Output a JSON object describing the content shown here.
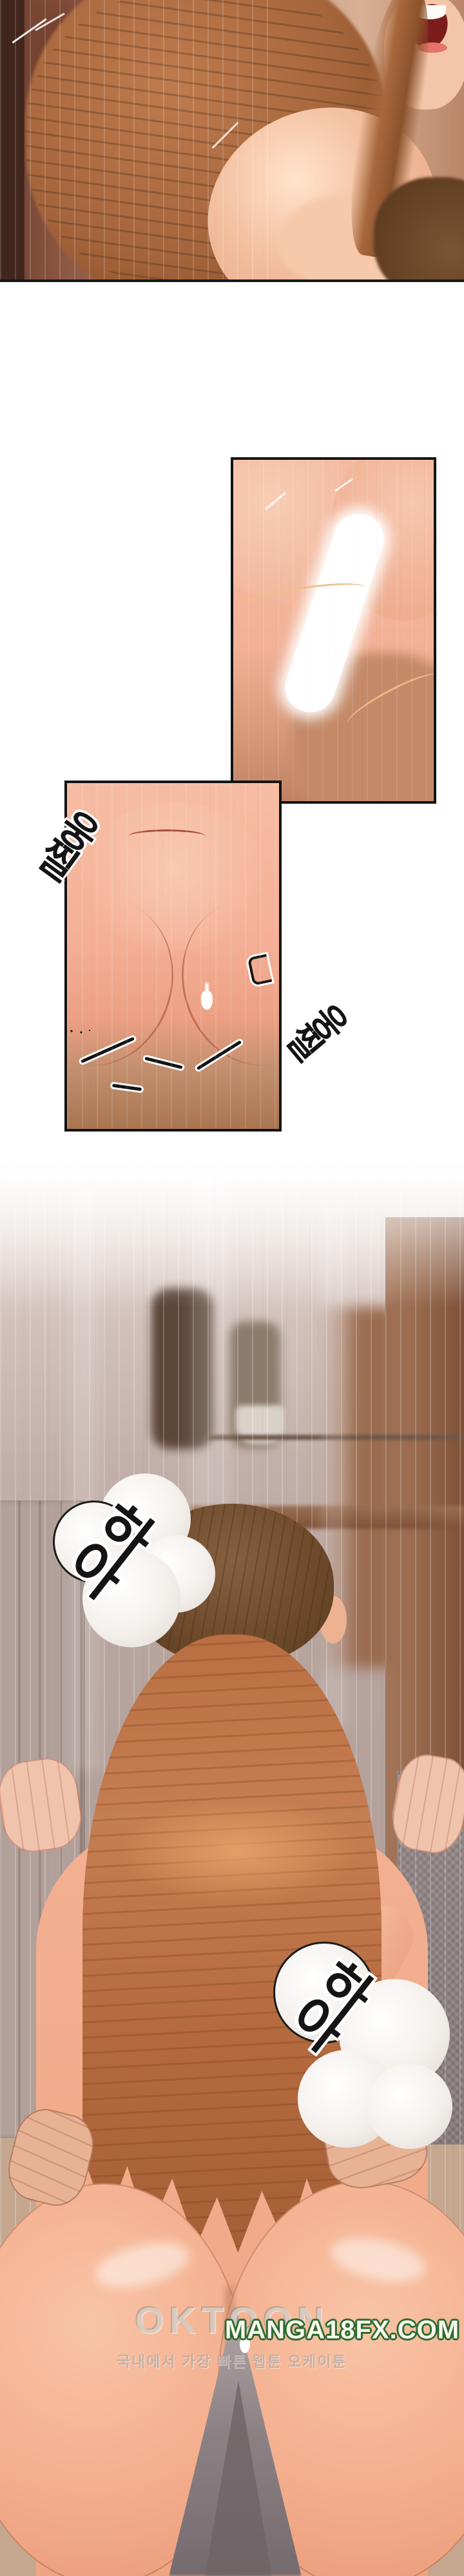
{
  "page": {
    "type": "webtoon-episode-strip",
    "language": "Korean",
    "background": "#ffffff"
  },
  "sfx": {
    "moan_1": "하아",
    "moan_2": "하아",
    "twitch_1": "웅찔",
    "twitch_2": "웅찔"
  },
  "watermark": {
    "site_name": "OKTOON",
    "site_url": "MANGA18FX.COM",
    "tagline_korean": "국내에서 가장 빠른 웹툰 오케이툰"
  },
  "panels": {
    "panel_1": "full-bleed close-up of two figures, auburn-haired woman in profile, warm wall background",
    "panel_2": "bordered close-up with bright white highlight shape over skin tones",
    "panel_3": "bordered lower-body close-up with sound-effect squiggles",
    "panel_4": "tall shower-room scene, man's brown head and woman's long auburn hair from behind, blurred shelf with bottles, wood and tile walls"
  },
  "palette": {
    "skin_light": "#f5c3ab",
    "skin_mid": "#f0ad8d",
    "skin_tan": "#c08264",
    "hair_woman": "#b06a42",
    "hair_man": "#6f4a2b",
    "wood_wall": "#9b6b4e",
    "mauve_wall": "#c4b1ab",
    "panel_border": "#131313",
    "sfx_ink": "#141414",
    "sfx_outline": "#ffffff",
    "watermark_url_fill": "#f7f9ef",
    "watermark_url_outline": "#2f6b2f",
    "watermark_gray": "#cdc4bc"
  }
}
